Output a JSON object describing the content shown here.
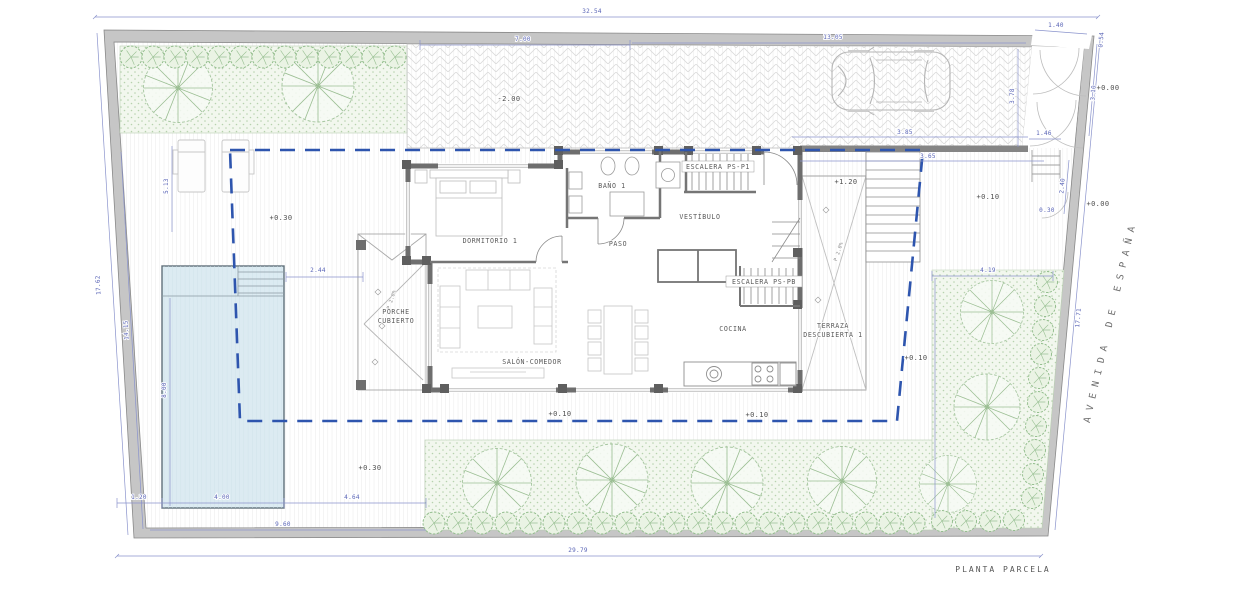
{
  "labels": {
    "title": "PLANTA PARCELA",
    "street": "AVENIDA DE ESPAÑA"
  },
  "rooms": {
    "dormitorio": "DORMITORIO 1",
    "bano": "BAÑO 1",
    "escalera_ps_p1": "ESCALERA PS-P1",
    "vestibulo": "VESTÍBULO",
    "paso": "PASO",
    "escalera_ps_pb": "ESCALERA PS-PB",
    "cocina": "COCINA",
    "salon_comedor": "SALÓN-COMEDOR",
    "porche_line1": "PORCHE",
    "porche_line2": "CUBIERTO",
    "terraza_line1": "TERRAZA",
    "terraza_line2": "DESCUBIERTA 1"
  },
  "levels": {
    "deck_upper": "+0.30",
    "deck_lower": "+0.30",
    "ramp": "-2.00",
    "stair_landing": "+1.20",
    "street_a": "+0.00",
    "street_b": "+0.00",
    "garden_ne": "+0.10",
    "garden_e": "+0.10",
    "garden_s1": "+0.10",
    "garden_s2": "+0.10",
    "slope_porche": "P 2.0%",
    "slope_terraza": "P 2.0%"
  },
  "dims": {
    "top_total": "32.54",
    "ramp_width": "7.00",
    "drive_width": "13.05",
    "gate_width": "1.40",
    "corner": "0.54",
    "gate_side": "3.10",
    "drive_depth": "3.78",
    "entry_a": "3.85",
    "entry_b": "3.65",
    "entry_c": "1.46",
    "side_a": "2.40",
    "wall_off": "0.30",
    "right_total": "17.71",
    "bed_e_width": "4.19",
    "pool_gap": "2.44",
    "pool_width": "4.00",
    "pool_length": "8.00",
    "pool_margin": "1.20",
    "deck_s": "4.64",
    "deck_s_total": "9.60",
    "bottom_total": "29.79",
    "left_total": "17.62",
    "left_garden": "14.15",
    "deck_w": "5.13"
  },
  "colors": {
    "setback_dash": "#2e55ae",
    "dimension_blue": "#5964b6",
    "wall_gray": "#6e6e6e",
    "pool_blue": "#dcebf2",
    "tree_green": "#9cbf94"
  }
}
